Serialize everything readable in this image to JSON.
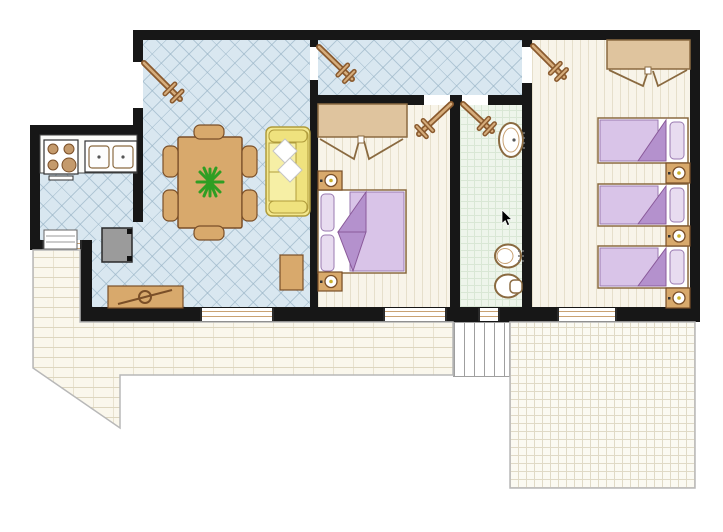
{
  "plan": {
    "type": "apartment-floor-plan",
    "cursor": {
      "x": 502,
      "y": 210
    },
    "rooms": [
      {
        "id": "living-dining-room",
        "floor": "blue-diagonal-tile"
      },
      {
        "id": "kitchen",
        "floor": "blue-diagonal-tile"
      },
      {
        "id": "entrance-hall",
        "floor": "blue-diagonal-tile"
      },
      {
        "id": "master-bedroom",
        "floor": "wood-plank"
      },
      {
        "id": "bathroom",
        "floor": "green-tile"
      },
      {
        "id": "twin-bedroom",
        "floor": "wood-plank"
      },
      {
        "id": "terrace-main",
        "floor": "brick-pavers"
      },
      {
        "id": "terrace-right",
        "floor": "square-pavers"
      },
      {
        "id": "terrace-steps",
        "floor": "stairs"
      }
    ],
    "furniture": {
      "kitchen": [
        "counter",
        "stove-4-burners",
        "double-sink",
        "radiator",
        "fridge"
      ],
      "living_dining": [
        "dining-table",
        "chairs-6",
        "plant-centerpiece",
        "sofa-2-seat",
        "tv-sideboard",
        "side-table"
      ],
      "master_bedroom": [
        "wardrobe-open",
        "double-bed",
        "nightstand-lamp-2"
      ],
      "bathroom": [
        "washbasin",
        "bidet",
        "toilet"
      ],
      "twin_bedroom": [
        "wardrobe-open",
        "single-bed-3",
        "nightstand-lamp-3"
      ]
    },
    "palette": {
      "wall": "#171717",
      "tile_blue": "#d9e7f0",
      "wood_floor": "#f8f4e9",
      "bath_floor": "#eef5eb",
      "terrace": "#faf7ec",
      "furniture_tan": "#d8a96c",
      "furniture_outline": "#7a4f28",
      "wardrobe": "#dfc49e",
      "bed_cover": "#d9c4e8",
      "bed_fold": "#b491cd",
      "pillow": "#e8dcf0",
      "sofa_yellow": "#f3e88f",
      "door_leaf": "#d6ad7c",
      "plant_green": "#2f9e23"
    },
    "doors": [
      {
        "id": "entrance-door",
        "hinge": [
          144,
          63
        ],
        "tip": [
          180,
          99
        ]
      },
      {
        "id": "hall-door",
        "hinge": [
          319,
          47
        ],
        "tip": [
          352,
          79
        ]
      },
      {
        "id": "twin-bedroom-door",
        "hinge": [
          533,
          46
        ],
        "tip": [
          564,
          77
        ]
      },
      {
        "id": "master-bedroom-door",
        "hinge": [
          451,
          104
        ],
        "tip": [
          419,
          134
        ]
      },
      {
        "id": "bathroom-door",
        "hinge": [
          463,
          104
        ],
        "tip": [
          492,
          131
        ]
      }
    ],
    "windows": [
      {
        "id": "living-window",
        "x": 200,
        "y": 308,
        "w": 70,
        "h": 13
      },
      {
        "id": "master-window",
        "x": 383,
        "y": 308,
        "w": 60,
        "h": 13
      },
      {
        "id": "bathroom-window",
        "x": 478,
        "y": 308,
        "w": 18,
        "h": 13
      },
      {
        "id": "twin-window",
        "x": 557,
        "y": 308,
        "w": 56,
        "h": 13
      },
      {
        "id": "kitchen-window",
        "x": 42,
        "y": 240,
        "w": 36,
        "h": 10
      }
    ],
    "twin_beds": [
      {
        "y": 118,
        "h": 45
      },
      {
        "y": 184,
        "h": 42
      },
      {
        "y": 246,
        "h": 42
      }
    ],
    "twin_nightstands": [
      163,
      226,
      288
    ],
    "master_nightstands": [
      171,
      272
    ]
  }
}
